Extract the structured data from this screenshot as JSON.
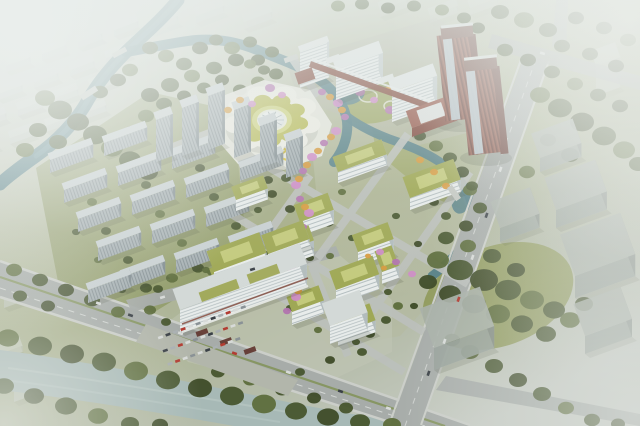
{
  "scene": {
    "type": "aerial-architectural-rendering",
    "description": "Bird's-eye masterplan rendering of a riverside medical campus: a lotus-shaped landmark hall with a white ribbed dome sits on a white plaza ringed by water; three stepped white inpatient slab buildings and twin red-brick high-rise towers stand to the north-east; a grid of white research buildings with green roofs is crossed by a winding garden spine of purple and orange blossom trees; a large white hospital slab with green roof podium and a parking lot fronts the main tree-lined boulevard; rows of gray residential slab housing with point towers fill the west block; canals and a foreground river wind through dense tree belts, and the surrounding city fades into white mist at the edges.",
    "regions": [
      {
        "label": "lotus-landmark-hall"
      },
      {
        "label": "hospital-complex"
      },
      {
        "label": "inpatient-slab-buildings"
      },
      {
        "label": "red-brick-towers"
      },
      {
        "label": "green-roof-campus"
      },
      {
        "label": "garden-spine"
      },
      {
        "label": "residential-district"
      },
      {
        "label": "riverfront"
      },
      {
        "label": "boulevard"
      },
      {
        "label": "city-context"
      }
    ]
  },
  "palette": {
    "mist": "#edf0ee",
    "terrain": "#a9b188",
    "lawn": "#9aa45e",
    "treeDark": "#47552e",
    "treeMid": "#5d6d3c",
    "accentPurple": "#b173ae",
    "accentPurple2": "#cd8cc6",
    "accentOrange": "#d79a3e",
    "riverTeal": "#557f87",
    "riverLight": "#a7b9b6",
    "roadGray": "#a7aca9",
    "roadLight": "#bcc0bc",
    "sidewalk": "#cbcec9",
    "medianGreen": "#84945c",
    "residentialFace": "#a6b0b3",
    "residentialSide": "#7f8b8f",
    "residentialRoof": "#c8d0d2",
    "whiteFacade": "#e8eceb",
    "facadeStripe": "#b4bec0",
    "sideShadow": "#b2bcbd",
    "greenRoof": "#9fa855",
    "greenRoofLight": "#c5cb7e",
    "hospitalRoof": "#d3d9d7",
    "redBrick": "#7e4437",
    "redBrickDark": "#5f332b",
    "glassBlue": "#b7cad2",
    "domeWhite": "#eaeeed",
    "lotusRing": "#b7ba55",
    "lotusRingLight": "#cfd480",
    "plazaWhite": "#e6e7de",
    "parking": "#b2b6ab",
    "carRed": "#b23c32",
    "shadow": "#39402e"
  }
}
